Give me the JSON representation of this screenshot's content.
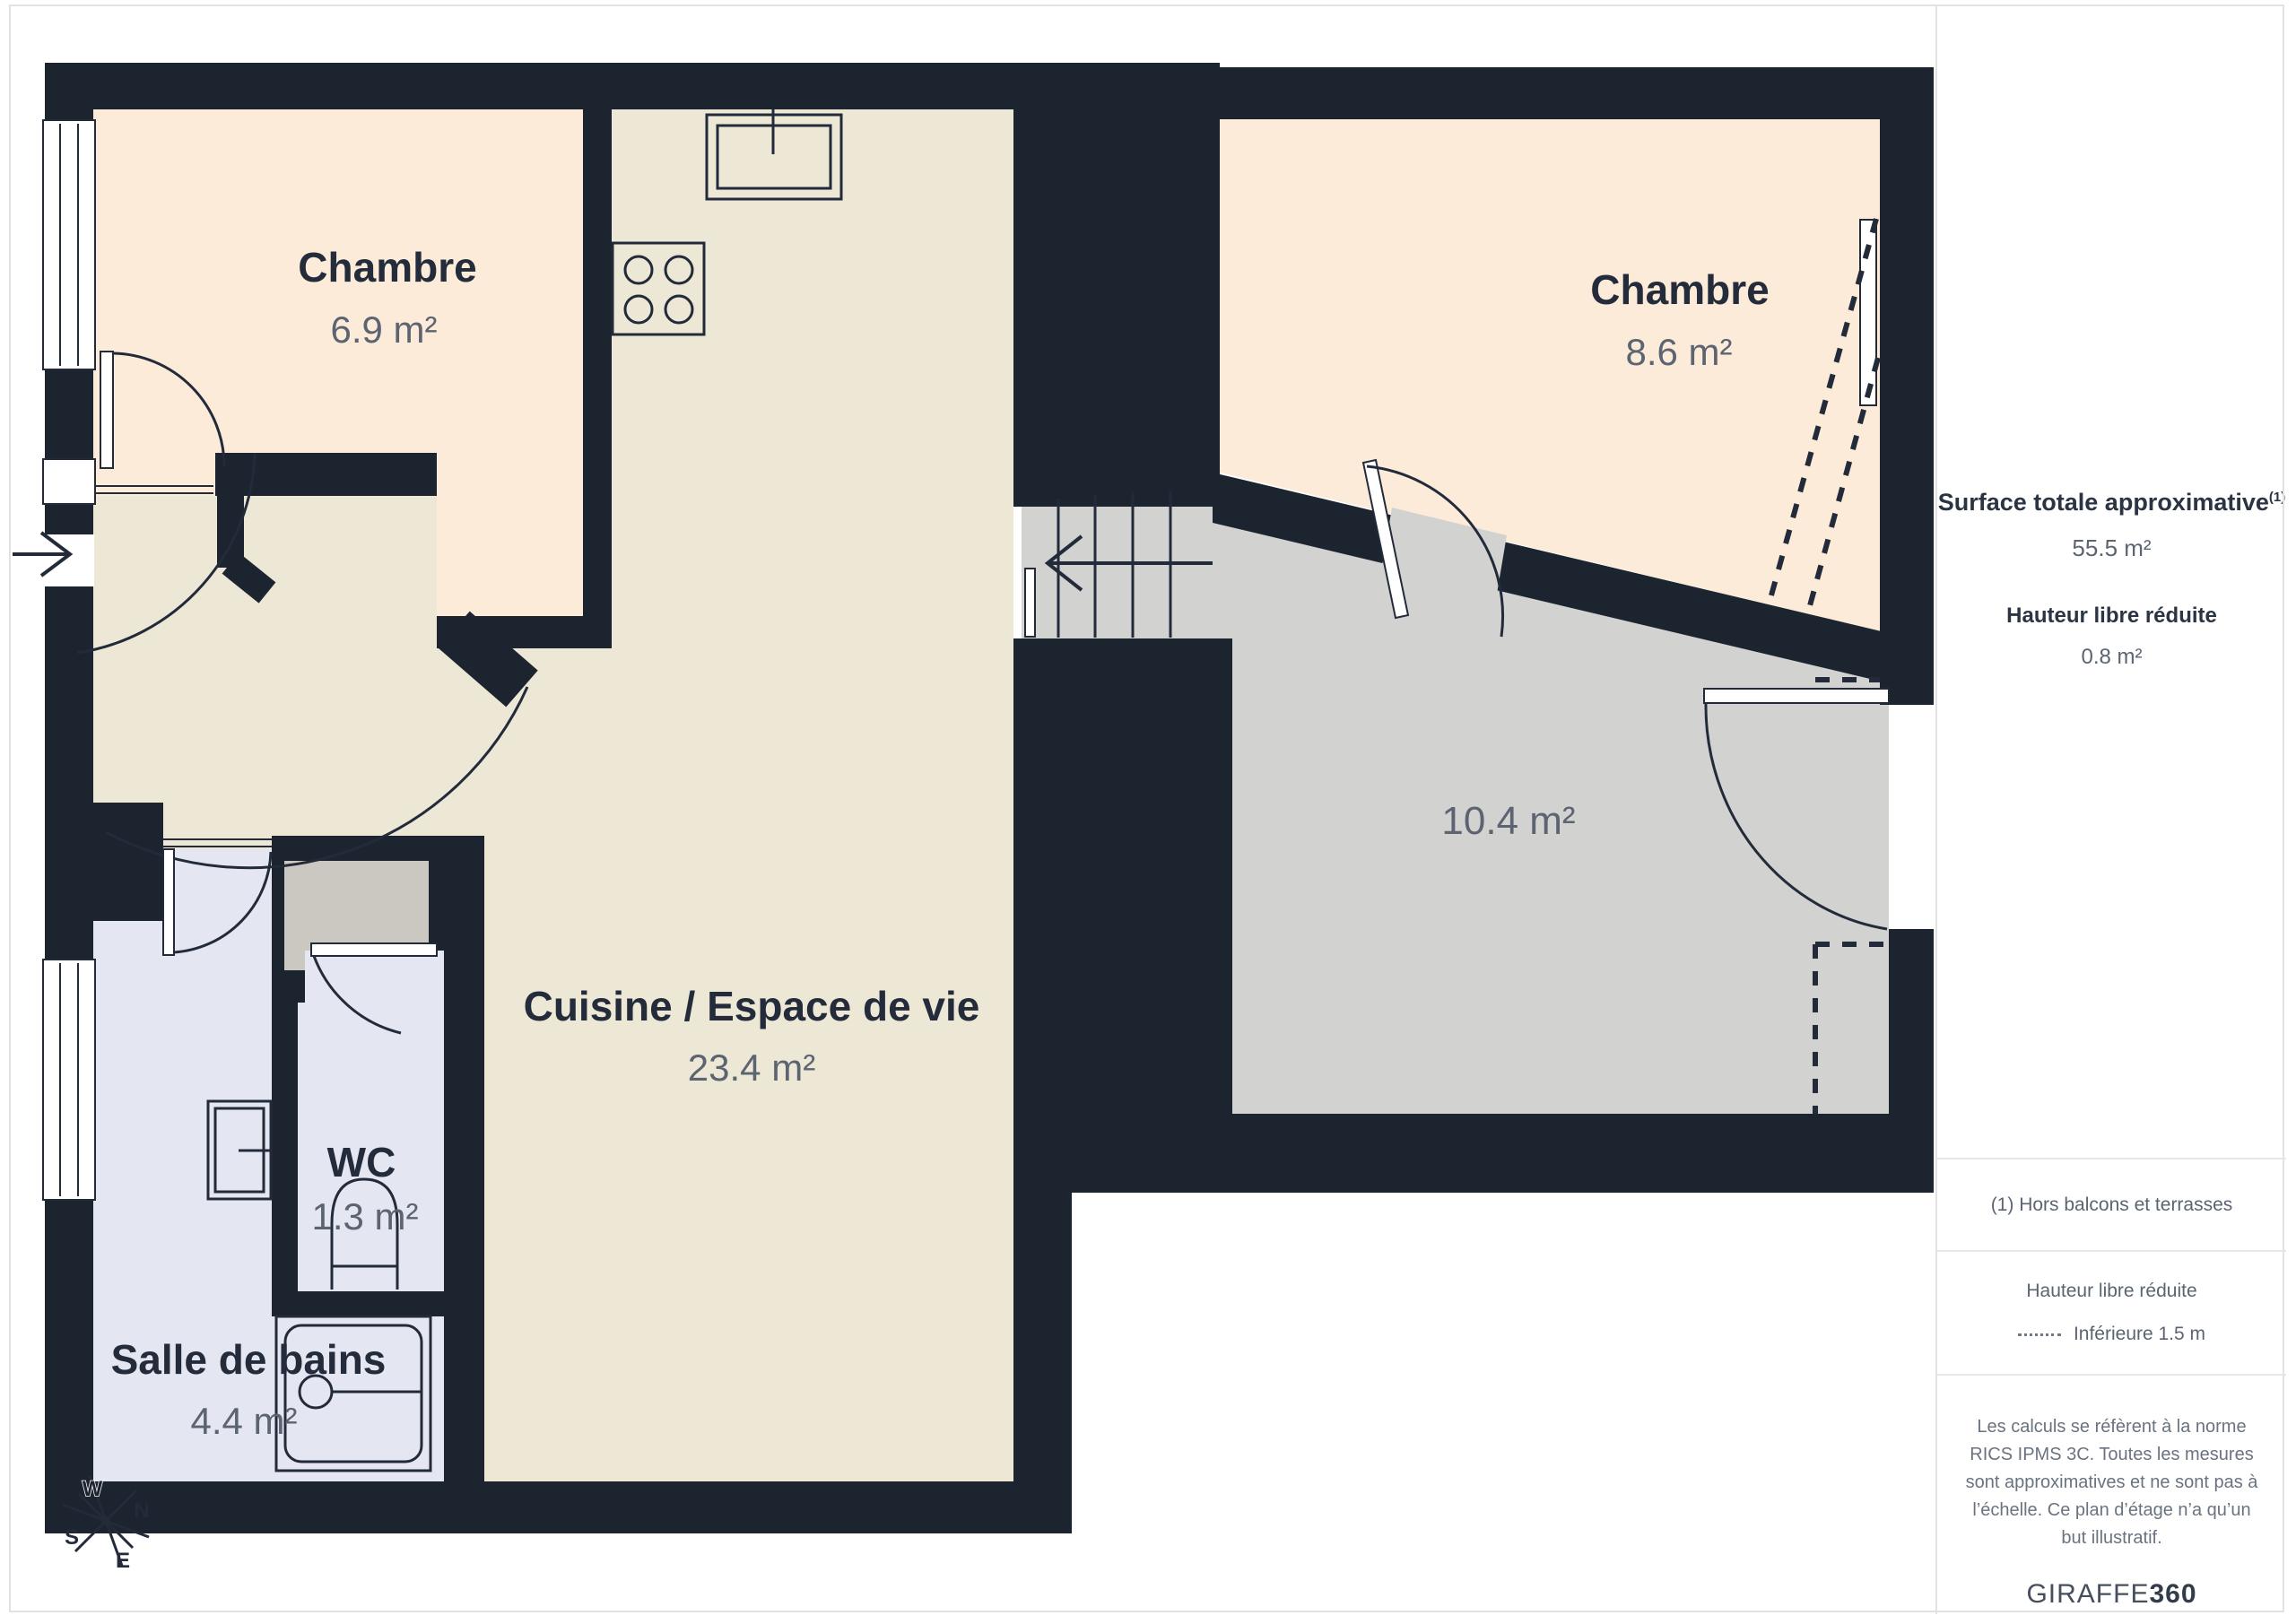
{
  "floorplan": {
    "rooms": [
      {
        "id": "chambre-1",
        "name": "Chambre",
        "area": "6.9 m²"
      },
      {
        "id": "chambre-2",
        "name": "Chambre",
        "area": "8.6 m²"
      },
      {
        "id": "cuisine",
        "name": "Cuisine / Espace de vie",
        "area": "23.4 m²"
      },
      {
        "id": "palier",
        "name": "",
        "area": "10.4 m²"
      },
      {
        "id": "wc",
        "name": "WC",
        "area": "1.3 m²"
      },
      {
        "id": "salle-de-bains",
        "name": "Salle de bains",
        "area": "4.4 m²"
      }
    ],
    "compass": {
      "north": "N",
      "south": "S",
      "east": "E",
      "west": "W"
    },
    "colors": {
      "wall": "#1C2430",
      "kitchen_floor": "#EDE7D6",
      "bedroom_floor": "#FCEBD8",
      "bathroom_floor": "#E4E7F1",
      "landing_floor": "#D2D2D1",
      "closet_floor": "#CBC8C2",
      "label_dark": "#242C3B",
      "label_gray": "#5B6470"
    }
  },
  "sidebar": {
    "surface_title": "Surface totale approximative",
    "surface_title_sup": "(1)",
    "surface_value": "55.5 m²",
    "reduced_height_title": "Hauteur libre réduite",
    "reduced_height_value": "0.8 m²",
    "footnote": "(1) Hors balcons et terrasses",
    "legend_title": "Hauteur libre réduite",
    "legend_item": "Inférieure 1.5 m",
    "disclaimer": "Les calculs se réfèrent à la norme RICS IPMS 3C. Toutes les mesures sont approximatives et ne sont pas à l’échelle. Ce plan d’étage n’a qu’un but illustratif.",
    "brand": {
      "name": "GIRAFFE",
      "suffix": "360"
    }
  }
}
